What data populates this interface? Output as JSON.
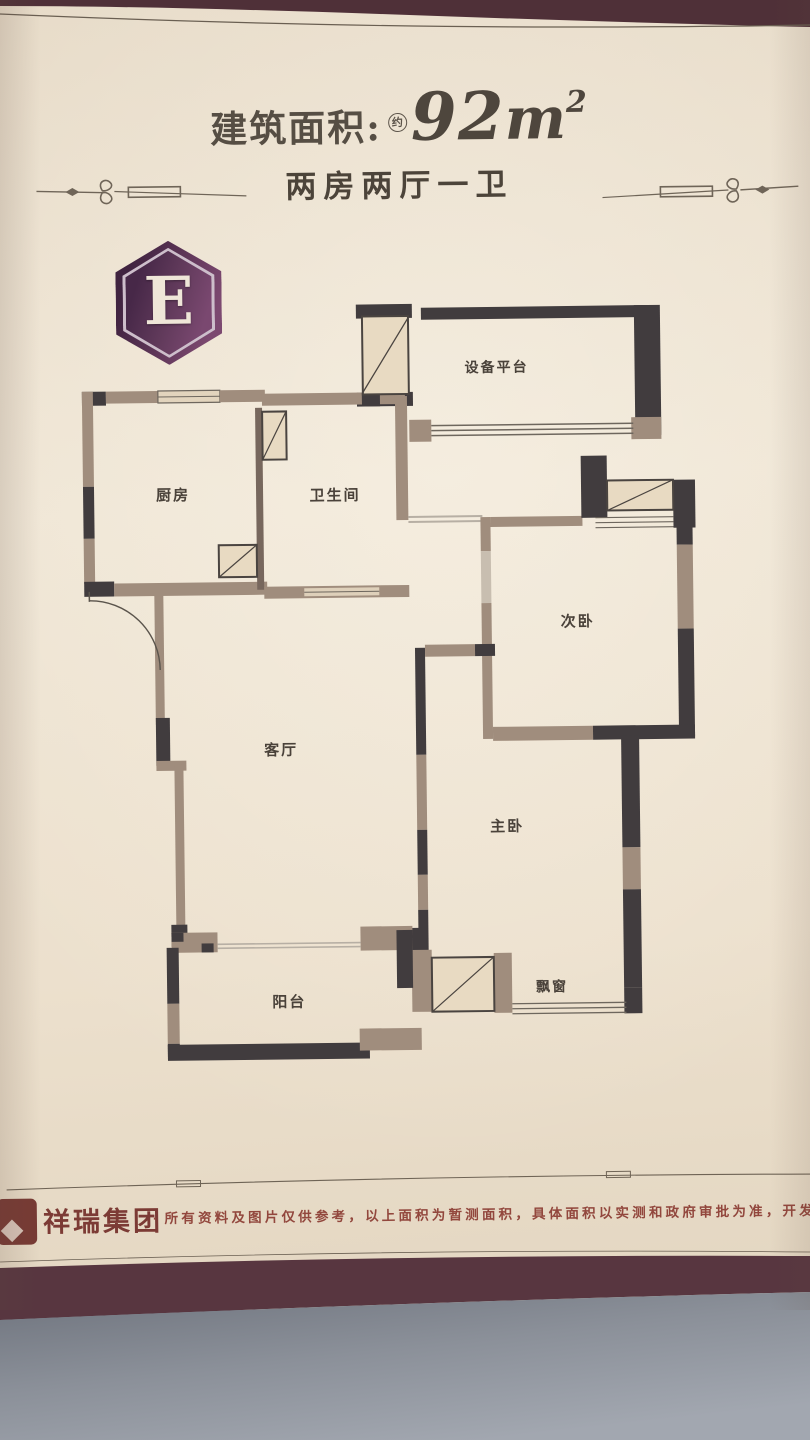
{
  "header": {
    "title_label": "建筑面积:",
    "approx_mark": "约",
    "area_value": "92",
    "area_unit": "m",
    "area_sup": "2",
    "subtitle": "两房两厅一卫"
  },
  "unit_badge": {
    "letter": "E"
  },
  "floor_plan": {
    "rooms": [
      {
        "id": "equipment-platform",
        "label": "设备平台"
      },
      {
        "id": "kitchen",
        "label": "厨房"
      },
      {
        "id": "bathroom",
        "label": "卫生间"
      },
      {
        "id": "second-bedroom",
        "label": "次卧"
      },
      {
        "id": "living-room",
        "label": "客厅"
      },
      {
        "id": "master-bedroom",
        "label": "主卧"
      },
      {
        "id": "balcony",
        "label": "阳台"
      },
      {
        "id": "bay-window",
        "label": "飘窗"
      }
    ]
  },
  "footer": {
    "brand": "祥瑞集团",
    "separator": "·",
    "disclaimer": "所有资料及图片仅供参考，以上面积为暂测面积，具体面积以实测和政府审批为准，开发商保有最终解"
  },
  "colors": {
    "paper": "#ece0cd",
    "wall_dark": "#413c3e",
    "wall_tan": "#a08d7d",
    "badge_purple": "#5d3557",
    "brand_red": "#7c3b35",
    "edge_maroon": "#583640",
    "table_gray": "#8b8f98"
  }
}
